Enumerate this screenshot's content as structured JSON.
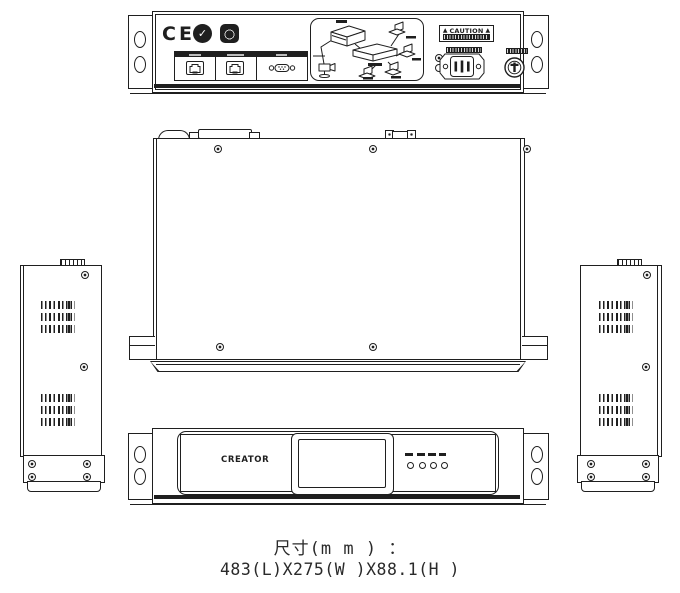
{
  "drawing": {
    "type": "mechanical-outline-drawing",
    "ink_color": "#1f1f1f",
    "background_color": "#ffffff"
  },
  "rear_panel": {
    "ce_mark": "CE",
    "cert_check_glyph": "✓",
    "cert_logo_icons": [
      "circle-check-cert-logo",
      "rounded-square-cert-logo"
    ],
    "port_icons": [
      "rj45-port",
      "rj45-port",
      "vga-port"
    ],
    "caution_label": {
      "title": "CAUTION",
      "warning_icon": "▲"
    },
    "power_icons": [
      "ground-terminal",
      "iec-c14-power-inlet",
      "fuse-holder"
    ],
    "connection_diagram_icon": "system-topology-illustration"
  },
  "side_panels": {
    "vent_groups_per_side": 2
  },
  "top_panel": {
    "screw_count": 6
  },
  "front_panel": {
    "brand": "CREATOR",
    "led_count": 4,
    "display_icon": "lcd-window"
  },
  "dimensions": {
    "label": "尺寸(m m ) ：",
    "value": "483(L)X275(W )X88.1(H )"
  }
}
